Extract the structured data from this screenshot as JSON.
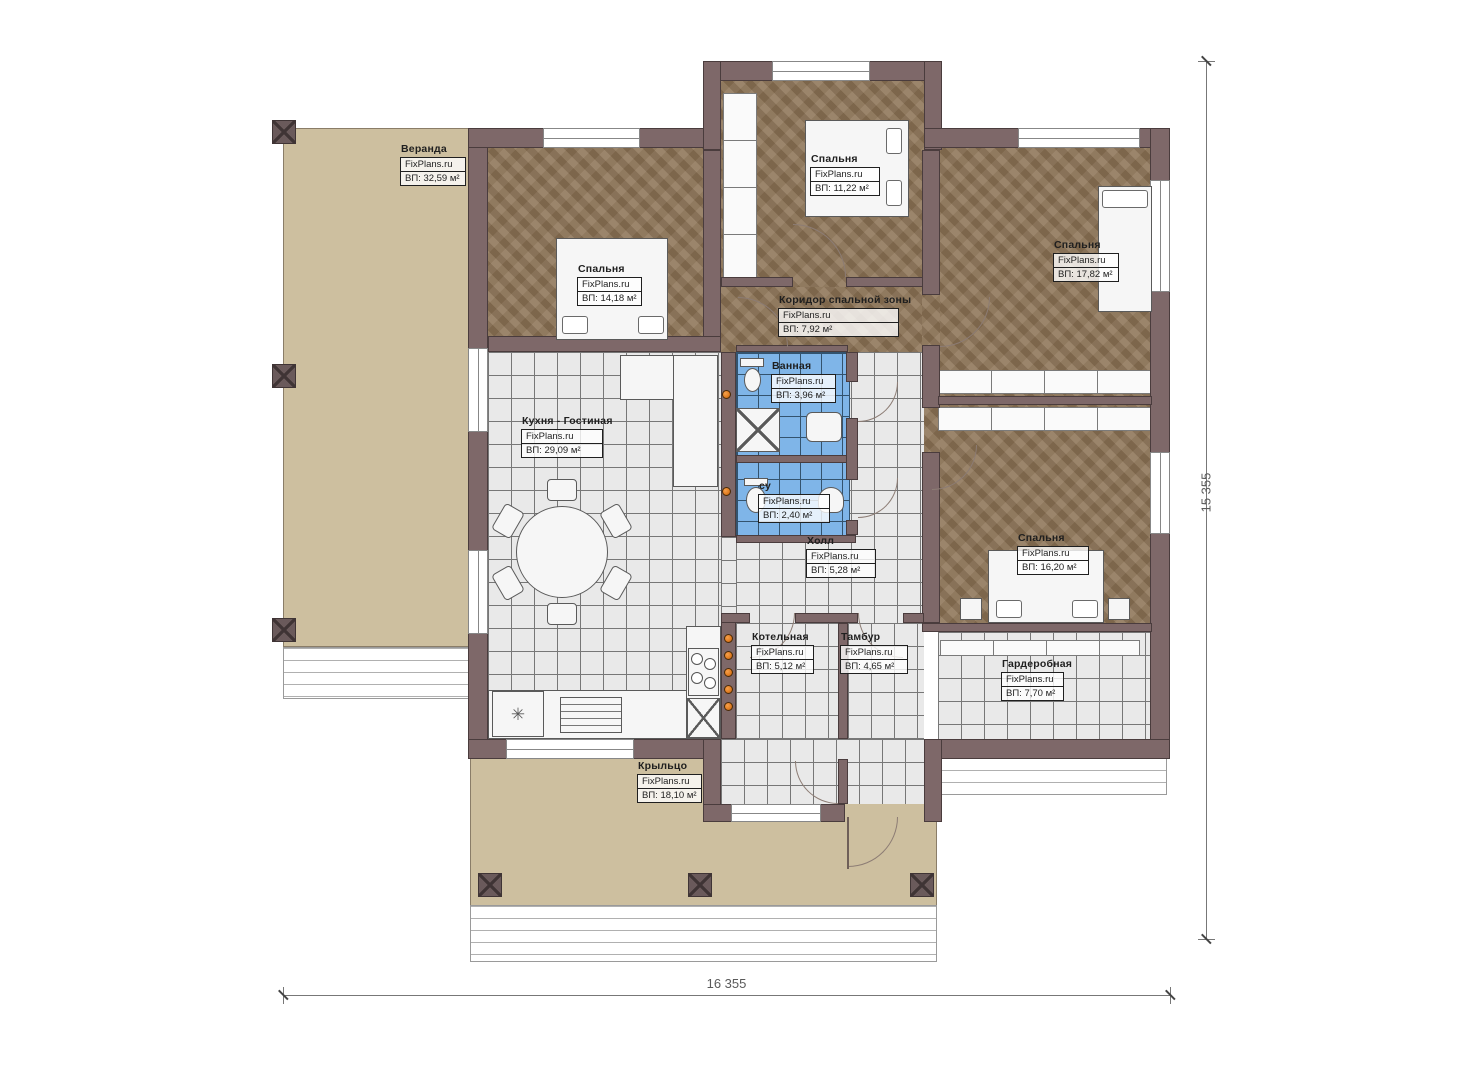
{
  "branding": {
    "watermark": "FixPlans.ru"
  },
  "dimensions": {
    "width_label": "16 355",
    "height_label": "15 355"
  },
  "icons": {
    "snowflake": "✳"
  },
  "colors": {
    "wall": "#7e6869",
    "wall-line": "#4a3c3d",
    "parquet": "#8d7456",
    "tan": "#cdbf9f",
    "tile-bg": "#e9e9e9",
    "tile-line": "#777777",
    "blue-bg": "#7fb5e8",
    "blue-line": "#33536e",
    "accent": "#e07b1f",
    "ink": "#1f1f1f",
    "dim": "#5a5a5a"
  },
  "rooms": [
    {
      "name": "Веранда",
      "area": "ВП: 32,59 м²"
    },
    {
      "name": "Спальня",
      "area": "ВП: 14,18 м²"
    },
    {
      "name": "Спальня",
      "area": "ВП: 11,22 м²"
    },
    {
      "name": "Спальня",
      "area": "ВП: 17,82 м²"
    },
    {
      "name": "Коридор спальной зоны",
      "area": "ВП: 7,92 м²"
    },
    {
      "name": "Ванная",
      "area": "ВП: 3,96 м²"
    },
    {
      "name": "Кухня - Гостиная",
      "area": "ВП: 29,09 м²"
    },
    {
      "name": "су",
      "area": "ВП: 2,40 м²"
    },
    {
      "name": "Холл",
      "area": "ВП: 5,28 м²"
    },
    {
      "name": "Спальня",
      "area": "ВП: 16,20 м²"
    },
    {
      "name": "Котельная",
      "area": "ВП: 5,12 м²"
    },
    {
      "name": "Тамбур",
      "area": "ВП: 4,65 м²"
    },
    {
      "name": "Гардеробная",
      "area": "ВП: 7,70 м²"
    },
    {
      "name": "Крыльцо",
      "area": "ВП: 18,10 м²"
    }
  ]
}
